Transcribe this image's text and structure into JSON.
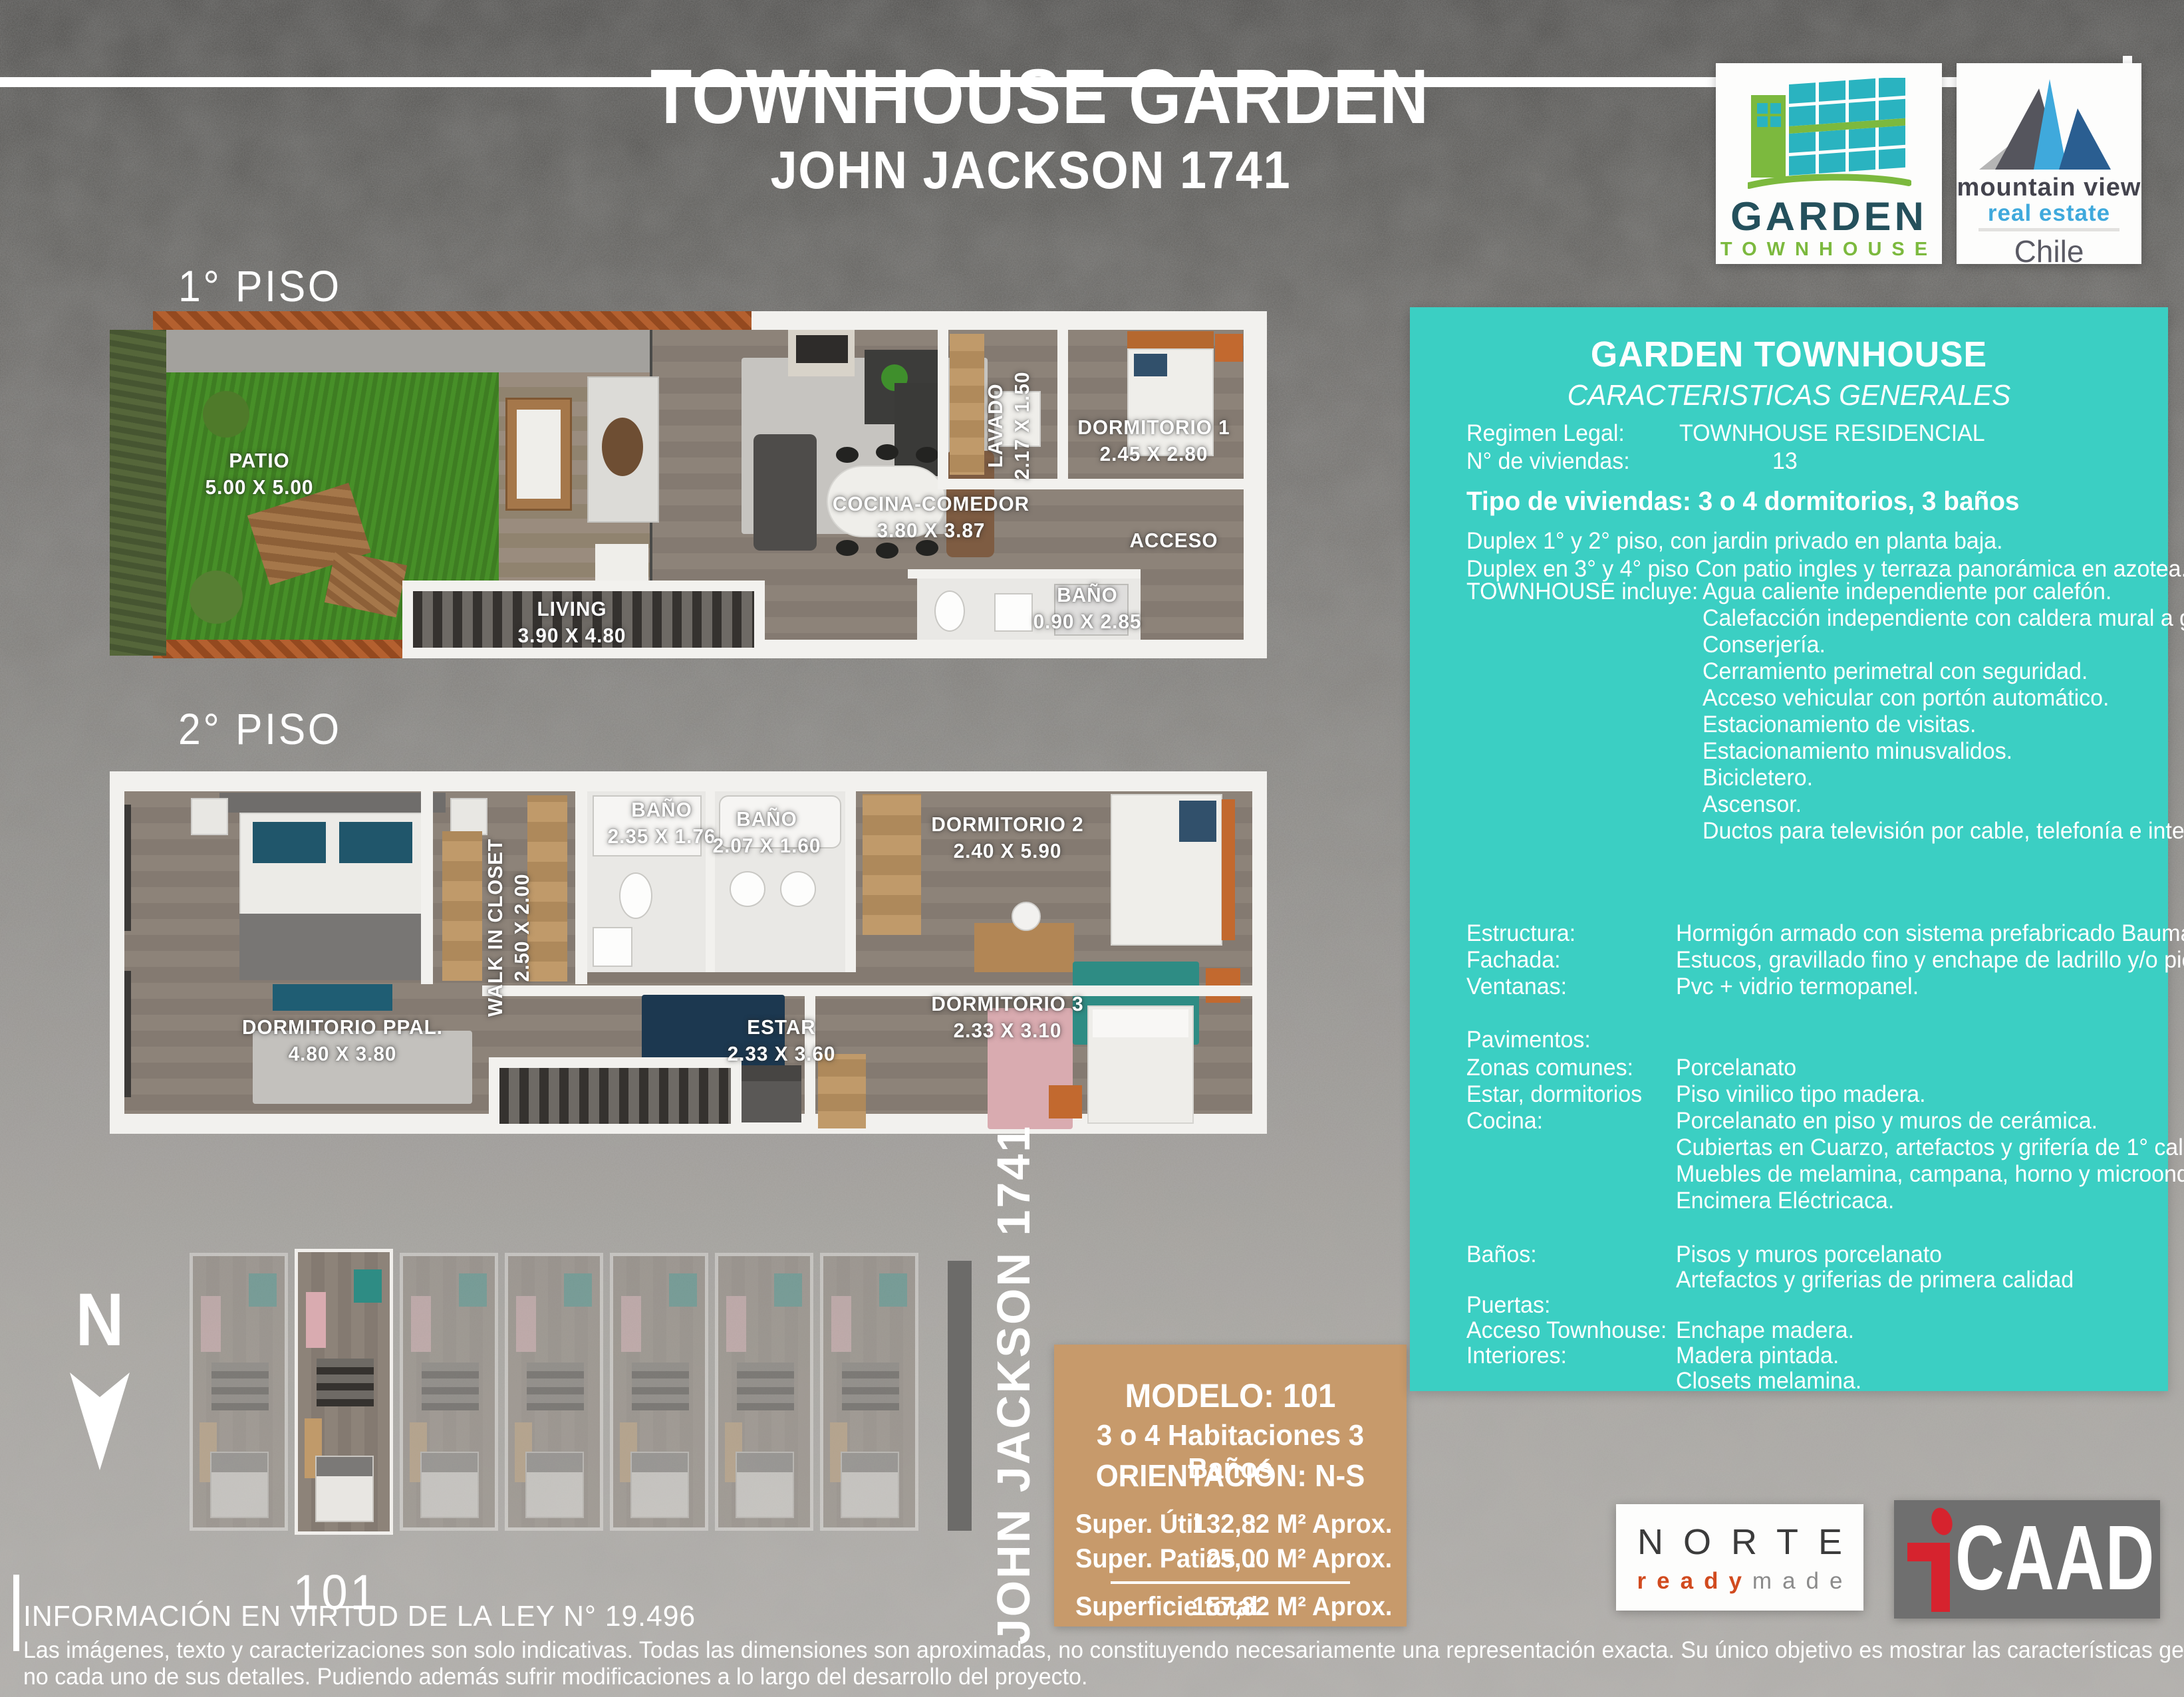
{
  "header": {
    "title": "TOWNHOUSE GARDEN",
    "subtitle": "JOHN JACKSON 1741"
  },
  "logos": {
    "garden": {
      "name": "GARDEN",
      "sub": "TOWNHOUSE"
    },
    "mountain_view": {
      "line1": "mountain view",
      "line2": "real estate",
      "country": "Chile"
    },
    "norte": {
      "name": "NORTE",
      "ready": "ready",
      "made": "made"
    },
    "icaad": {
      "caad": "CAAD"
    }
  },
  "floor1": {
    "heading": "1° PISO",
    "rooms": [
      {
        "name": "PATIO",
        "dims": "5.00 X 5.00"
      },
      {
        "name": "LIVING",
        "dims": "3.90 X 4.80"
      },
      {
        "name": "COCINA-COMEDOR",
        "dims": "3.80 X 3.87"
      },
      {
        "name": "LAVADO",
        "dims": "2.17 X 1.50"
      },
      {
        "name": "DORMITORIO 1",
        "dims": "2.45 X 2.80"
      },
      {
        "name": "BAÑO",
        "dims": "0.90 X 2.85"
      },
      {
        "name": "ACCESO",
        "dims": ""
      }
    ]
  },
  "floor2": {
    "heading": "2° PISO",
    "rooms": [
      {
        "name": "DORMITORIO PPAL.",
        "dims": "4.80 X 3.80"
      },
      {
        "name": "WALK IN CLOSET",
        "dims": "2.50 X 2.00"
      },
      {
        "name": "BAÑO",
        "dims": "2.35 X 1.76"
      },
      {
        "name": "BAÑO",
        "dims": "2.07 X 1.60"
      },
      {
        "name": "DORMITORIO 2",
        "dims": "2.40 X 5.90"
      },
      {
        "name": "DORMITORIO 3",
        "dims": "2.33 X 3.10"
      },
      {
        "name": "ESTAR",
        "dims": "2.33 X 3.60"
      }
    ]
  },
  "siteplan": {
    "north_label": "N",
    "unit_label": "101",
    "street_label": "JOHN JACKSON 1741"
  },
  "model": {
    "title": "MODELO: 101",
    "line2": "3 o 4 Habitaciones 3 Baños",
    "line3": "ORIENTACIÓN: N-S",
    "rows": [
      {
        "label": "Super. Útil",
        "colon": ":",
        "value": "132,82 M² Aprox."
      },
      {
        "label": "Super. Patios",
        "colon": ":",
        "value": "25,00 M² Aprox."
      }
    ],
    "total_label": "Superficie total",
    "total_value": "157,82 M² Aprox."
  },
  "specs": {
    "title": "GARDEN TOWNHOUSE",
    "subtitle": "CARACTERISTICAS GENERALES",
    "regimen_label": "Regimen Legal:",
    "regimen_value": "TOWNHOUSE RESIDENCIAL",
    "viviendas_label": "N° de viviendas:",
    "viviendas_value": "13",
    "tipo": "Tipo de viviendas:  3 o 4 dormitorios, 3 baños",
    "duplex1": "Duplex 1° y 2° piso, con jardin privado en planta baja.",
    "duplex2": "Duplex en 3° y 4° piso Con patio ingles y terraza panorámica en azotea.",
    "incluye_label": "TOWNHOUSE incluye:",
    "incluye": [
      "Agua caliente independiente por calefón.",
      "Calefacción independiente con caldera mural a gas.",
      "Conserjería.",
      "Cerramiento perimetral con seguridad.",
      "Acceso vehicular con portón automático.",
      "Estacionamiento de visitas.",
      "Estacionamiento minusvalidos.",
      "Bicicletero.",
      "Ascensor.",
      "Ductos para televisión por cable, telefonía e internet."
    ],
    "rows1": [
      {
        "label": "Estructura:",
        "value": "Hormigón armado con sistema prefabricado Baumax."
      },
      {
        "label": "Fachada:",
        "value": "Estucos, gravillado fino y enchape de ladrillo y/o piedra."
      },
      {
        "label": "Ventanas:",
        "value": "Pvc + vidrio termopanel."
      }
    ],
    "pavimentos_label": "Pavimentos:",
    "rows2": [
      {
        "label": "Zonas comunes:",
        "value": "Porcelanato"
      },
      {
        "label": "Estar, dormitorios",
        "value": "Piso vinilico tipo madera."
      },
      {
        "label": "Cocina:",
        "value": "Porcelanato en piso y muros de cerámica."
      },
      {
        "label": "",
        "value": "Cubiertas en Cuarzo, artefactos y grifería de 1° calidad."
      },
      {
        "label": "",
        "value": "Muebles de melamina, campana, horno y microondas."
      },
      {
        "label": "",
        "value": "Encimera Eléctricaca."
      }
    ],
    "rows3": [
      {
        "label": "Baños:",
        "value": "Pisos y muros porcelanato"
      },
      {
        "label": "",
        "value": "Artefactos y griferias de primera calidad"
      },
      {
        "label": "Puertas:",
        "value": ""
      },
      {
        "label": "Acceso Townhouse:",
        "value": "Enchape madera."
      },
      {
        "label": "Interiores:",
        "value": "Madera pintada."
      },
      {
        "label": "",
        "value": "Closets melamina."
      }
    ]
  },
  "footer": {
    "line1": "INFORMACIÓN EN VIRTUD DE LA LEY N° 19.496",
    "line2": "Las imágenes, texto y caracterizaciones son solo indicativas. Todas las dimensiones son aproximadas, no constituyendo necesariamente una representación exacta. Su único objetivo es mostrar las características generales y",
    "line3": "no cada uno de sus detalles. Pudiendo además sufrir modificaciones a lo largo del desarrollo del proyecto."
  },
  "colors": {
    "teal_panel": "#3bcfc3",
    "tan_box": "#c79a6b",
    "logo_green": "#7cb93e",
    "logo_teal": "#2ab3c0",
    "logo_dark_teal": "#24505c",
    "mv_blue": "#3fa9dc",
    "mv_dark_blue": "#2a5e91",
    "norte_red": "#d14a1e",
    "icaad_red": "#d6232e"
  }
}
